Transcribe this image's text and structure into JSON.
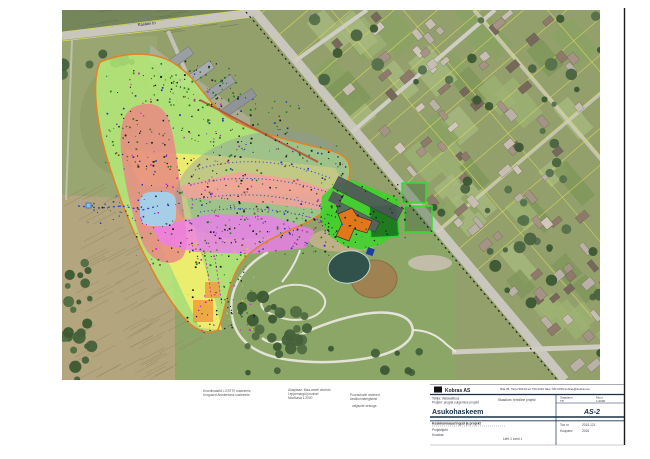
{
  "map": {
    "street_label": "Kastani tn",
    "accent_colors": {
      "overlay_green": "#b7ef7a",
      "overlay_yellow": "#f5ee6b",
      "overlay_red": "#e98a84",
      "overlay_magenta": "#ee7cee",
      "overlay_pink": "#f6a09a",
      "overlay_blue": "#9fd4f2",
      "overlay_orange_outline": "#e08428",
      "facility_green": "#3ed32b",
      "building_orange": "#e2761b"
    }
  },
  "notes": {
    "b1": [
      "Koordinaadid L-EST97 susteemis",
      "Korgused Amsterdami susteemis"
    ],
    "b2": [
      "Alusplaan: Maa-ameti ortofoto",
      "Leppemargid joonisel",
      "Mootkava 1:2000"
    ],
    "b3": [
      "Puuraukude andmed",
      "keskkonnaregistrist"
    ],
    "b4": "valjavote seisuga"
  },
  "titleblock": {
    "logo_text": "Kobras AS",
    "contact": "Riia 35, Tartu 50410   tel 730 0310   faks 730 0315   kobras@kobras.ee",
    "project_line1": "Tellija: Vallavalitsus",
    "project_line2": "Projekt: prugila sulgemise projekt",
    "center_small": "Staadium: tehniline projekt",
    "title_main": "Asukohaskeem",
    "staadium_label": "Staadium",
    "staadium_value": "TP",
    "moot_label": "Moot",
    "moot_value": "1:2000",
    "drawing_no": "AS-2",
    "toonr_label": "Too nr",
    "toonr_value": "2015-121",
    "kuupaev_label": "Kuupaev",
    "kuupaev_value": "2016",
    "sub_heading": "Keskkonnauuringud ja projekt",
    "sub_line1": "Projektijuht",
    "sub_line2": "Koostas",
    "leht": "Leht 1  Lehti 1"
  },
  "gen": [
    {
      "type": "hatch",
      "layer": "g-hatch",
      "seed": 7,
      "region": [
        62,
        195,
        123,
        185
      ],
      "count": 80,
      "angle": -28,
      "len": 26,
      "stroke": "rgba(150,135,100,0.55)",
      "w": 0.8
    },
    {
      "type": "hatch",
      "layer": "g-hatch",
      "seed": 9,
      "region": [
        62,
        10,
        190,
        24
      ],
      "count": 24,
      "angle": -8,
      "len": 18,
      "stroke": "rgba(90,105,70,0.5)",
      "w": 0.7
    },
    {
      "type": "lawn",
      "layer": "g-lawns",
      "seed": 11,
      "region": [
        300,
        12,
        300,
        120
      ],
      "count": 22,
      "minLine": [
        252,
        10,
        0.8505,
        8
      ],
      "colors": [
        "#9db173",
        "#8aa263",
        "#a8b97f",
        "#7e9659"
      ]
    },
    {
      "type": "lawn",
      "layer": "g-lawns",
      "seed": 12,
      "region": [
        370,
        140,
        230,
        120
      ],
      "count": 20,
      "minLine": [
        252,
        10,
        0.8505,
        8
      ],
      "colors": [
        "#9db173",
        "#8aa263",
        "#a8b97f",
        "#7e9659"
      ]
    },
    {
      "type": "lawn",
      "layer": "g-lawns",
      "seed": 13,
      "region": [
        430,
        262,
        190,
        110
      ],
      "count": 16,
      "minLine": [
        252,
        10,
        0.8505,
        8
      ],
      "colors": [
        "#9db173",
        "#8aa263",
        "#a8b97f",
        "#7e9659"
      ]
    },
    {
      "type": "house",
      "layer": "g-houses",
      "seed": 21,
      "region": [
        300,
        12,
        295,
        118
      ],
      "count": 46,
      "minLine": [
        252,
        10,
        0.8505,
        12
      ],
      "colors": [
        "#b9b0a6",
        "#a59486",
        "#8e7a6a",
        "#c7beb2",
        "#77685c",
        "#d0c6ba"
      ]
    },
    {
      "type": "house",
      "layer": "g-houses",
      "seed": 22,
      "region": [
        370,
        138,
        230,
        122
      ],
      "count": 40,
      "minLine": [
        252,
        10,
        0.8505,
        12
      ],
      "colors": [
        "#b9b0a6",
        "#a59486",
        "#8e7a6a",
        "#c7beb2",
        "#77685c",
        "#d0c6ba"
      ]
    },
    {
      "type": "house",
      "layer": "g-houses",
      "seed": 23,
      "region": [
        430,
        262,
        190,
        108
      ],
      "count": 28,
      "minLine": [
        252,
        10,
        0.8505,
        12
      ],
      "colors": [
        "#b9b0a6",
        "#a59486",
        "#8e7a6a",
        "#c7beb2",
        "#77685c"
      ]
    },
    {
      "type": "house",
      "layer": "g-houses",
      "seed": 24,
      "region": [
        470,
        352,
        150,
        24
      ],
      "count": 8,
      "minLine": [
        252,
        10,
        0.8505,
        12
      ],
      "colors": [
        "#b9b0a6",
        "#a59486",
        "#8e7a6a"
      ]
    },
    {
      "type": "tree",
      "layer": "g-trees",
      "seed": 31,
      "region": [
        240,
        285,
        70,
        66
      ],
      "count": 26,
      "colors": [
        "#44603a",
        "#3c5733",
        "#506b41"
      ]
    },
    {
      "type": "tree",
      "layer": "g-trees",
      "seed": 32,
      "region": [
        62,
        235,
        30,
        145
      ],
      "count": 22,
      "colors": [
        "#44603a",
        "#3c5733",
        "#506b41"
      ]
    },
    {
      "type": "tree",
      "layer": "g-trees",
      "seed": 33,
      "region": [
        300,
        15,
        300,
        235
      ],
      "count": 55,
      "minLine": [
        252,
        10,
        0.8505,
        10
      ],
      "colors": [
        "#4a6340",
        "#3c5733",
        "#55704a"
      ]
    },
    {
      "type": "tree",
      "layer": "g-trees",
      "seed": 34,
      "region": [
        430,
        250,
        175,
        110
      ],
      "count": 22,
      "minLine": [
        252,
        10,
        0.8505,
        10
      ],
      "colors": [
        "#4a6340",
        "#3c5733"
      ]
    },
    {
      "type": "tree",
      "layer": "g-trees",
      "seed": 35,
      "region": [
        62,
        52,
        70,
        44
      ],
      "count": 8,
      "colors": [
        "#44603a",
        "#506b41"
      ]
    },
    {
      "type": "tree",
      "layer": "g-trees",
      "seed": 36,
      "region": [
        230,
        348,
        190,
        26
      ],
      "count": 10,
      "colors": [
        "#44603a",
        "#3c5733"
      ]
    },
    {
      "type": "ray",
      "layer": "g-parcels",
      "from": [
        258,
        16
      ],
      "step": [
        18.1,
        21.3
      ],
      "n": 13,
      "dir": [
        256,
        -218
      ],
      "stroke": "#d6d65f",
      "w": 0.7,
      "op": 0.85
    },
    {
      "type": "ray",
      "layer": "g-parcels",
      "from": [
        298,
        -29
      ],
      "step": [
        41.9,
        -35.6
      ],
      "n": 6,
      "dir": [
        294,
        346
      ],
      "stroke": "#d6d65f",
      "w": 0.7,
      "op": 0.85
    },
    {
      "type": "dot",
      "layer": "g-dots",
      "seed": 41,
      "region": [
        105,
        70,
        120,
        100
      ],
      "count": 160,
      "size": [
        0.8,
        1.8
      ],
      "colors": [
        "#1b1b1b",
        "#1b1b1b",
        "#157a15",
        "#157a15",
        "#cc22cc",
        "#2233bb",
        "#6b5a22"
      ]
    },
    {
      "type": "dot",
      "layer": "g-dots",
      "seed": 42,
      "region": [
        135,
        155,
        110,
        110
      ],
      "count": 170,
      "size": [
        0.8,
        1.8
      ],
      "colors": [
        "#1b1b1b",
        "#157a15",
        "#157a15",
        "#cc22cc",
        "#2233bb",
        "#6b5a22",
        "#1b1b1b"
      ]
    },
    {
      "type": "dot",
      "layer": "g-dots",
      "seed": 43,
      "region": [
        205,
        140,
        140,
        95
      ],
      "count": 150,
      "size": [
        0.8,
        1.8
      ],
      "colors": [
        "#1b1b1b",
        "#157a15",
        "#cc22cc",
        "#2233bb",
        "#6b5a22",
        "#1b1b1b"
      ]
    },
    {
      "type": "dot",
      "layer": "g-dots",
      "seed": 44,
      "region": [
        185,
        235,
        70,
        95
      ],
      "count": 90,
      "size": [
        0.8,
        1.8
      ],
      "colors": [
        "#1b1b1b",
        "#157a15",
        "#cc22cc",
        "#d6d32a",
        "#1b1b1b"
      ]
    },
    {
      "type": "dot",
      "layer": "g-dots",
      "seed": 45,
      "region": [
        255,
        205,
        90,
        50
      ],
      "count": 70,
      "size": [
        0.8,
        1.8
      ],
      "colors": [
        "#1b1b1b",
        "#157a15",
        "#cc22cc",
        "#2233bb"
      ]
    },
    {
      "type": "dot",
      "layer": "g-dots",
      "seed": 46,
      "region": [
        320,
        182,
        85,
        65
      ],
      "count": 55,
      "size": [
        0.8,
        1.8
      ],
      "colors": [
        "#1b1b1b",
        "#1b1b1b",
        "#157a15"
      ]
    },
    {
      "type": "dot",
      "layer": "g-dots",
      "seed": 47,
      "region": [
        230,
        95,
        70,
        60
      ],
      "count": 50,
      "size": [
        0.8,
        1.8
      ],
      "colors": [
        "#1b1b1b",
        "#157a15",
        "#2233bb"
      ]
    },
    {
      "type": "dot",
      "layer": "g-dots",
      "seed": 48,
      "region": [
        85,
        195,
        60,
        30
      ],
      "count": 30,
      "size": [
        0.8,
        1.6
      ],
      "colors": [
        "#2233bb",
        "#1b1b1b",
        "#2233bb"
      ]
    },
    {
      "type": "dot",
      "layer": "g-dots",
      "seed": 49,
      "region": [
        150,
        60,
        90,
        45
      ],
      "count": 60,
      "size": [
        0.8,
        1.8
      ],
      "colors": [
        "#157a15",
        "#157a15",
        "#1b1b1b"
      ]
    },
    {
      "type": "dot",
      "layer": "g-dots",
      "seed": 50,
      "region": [
        200,
        295,
        45,
        38
      ],
      "count": 30,
      "size": [
        0.8,
        1.6
      ],
      "colors": [
        "#1b1b1b",
        "#cc22cc",
        "#d6d32a"
      ]
    }
  ]
}
